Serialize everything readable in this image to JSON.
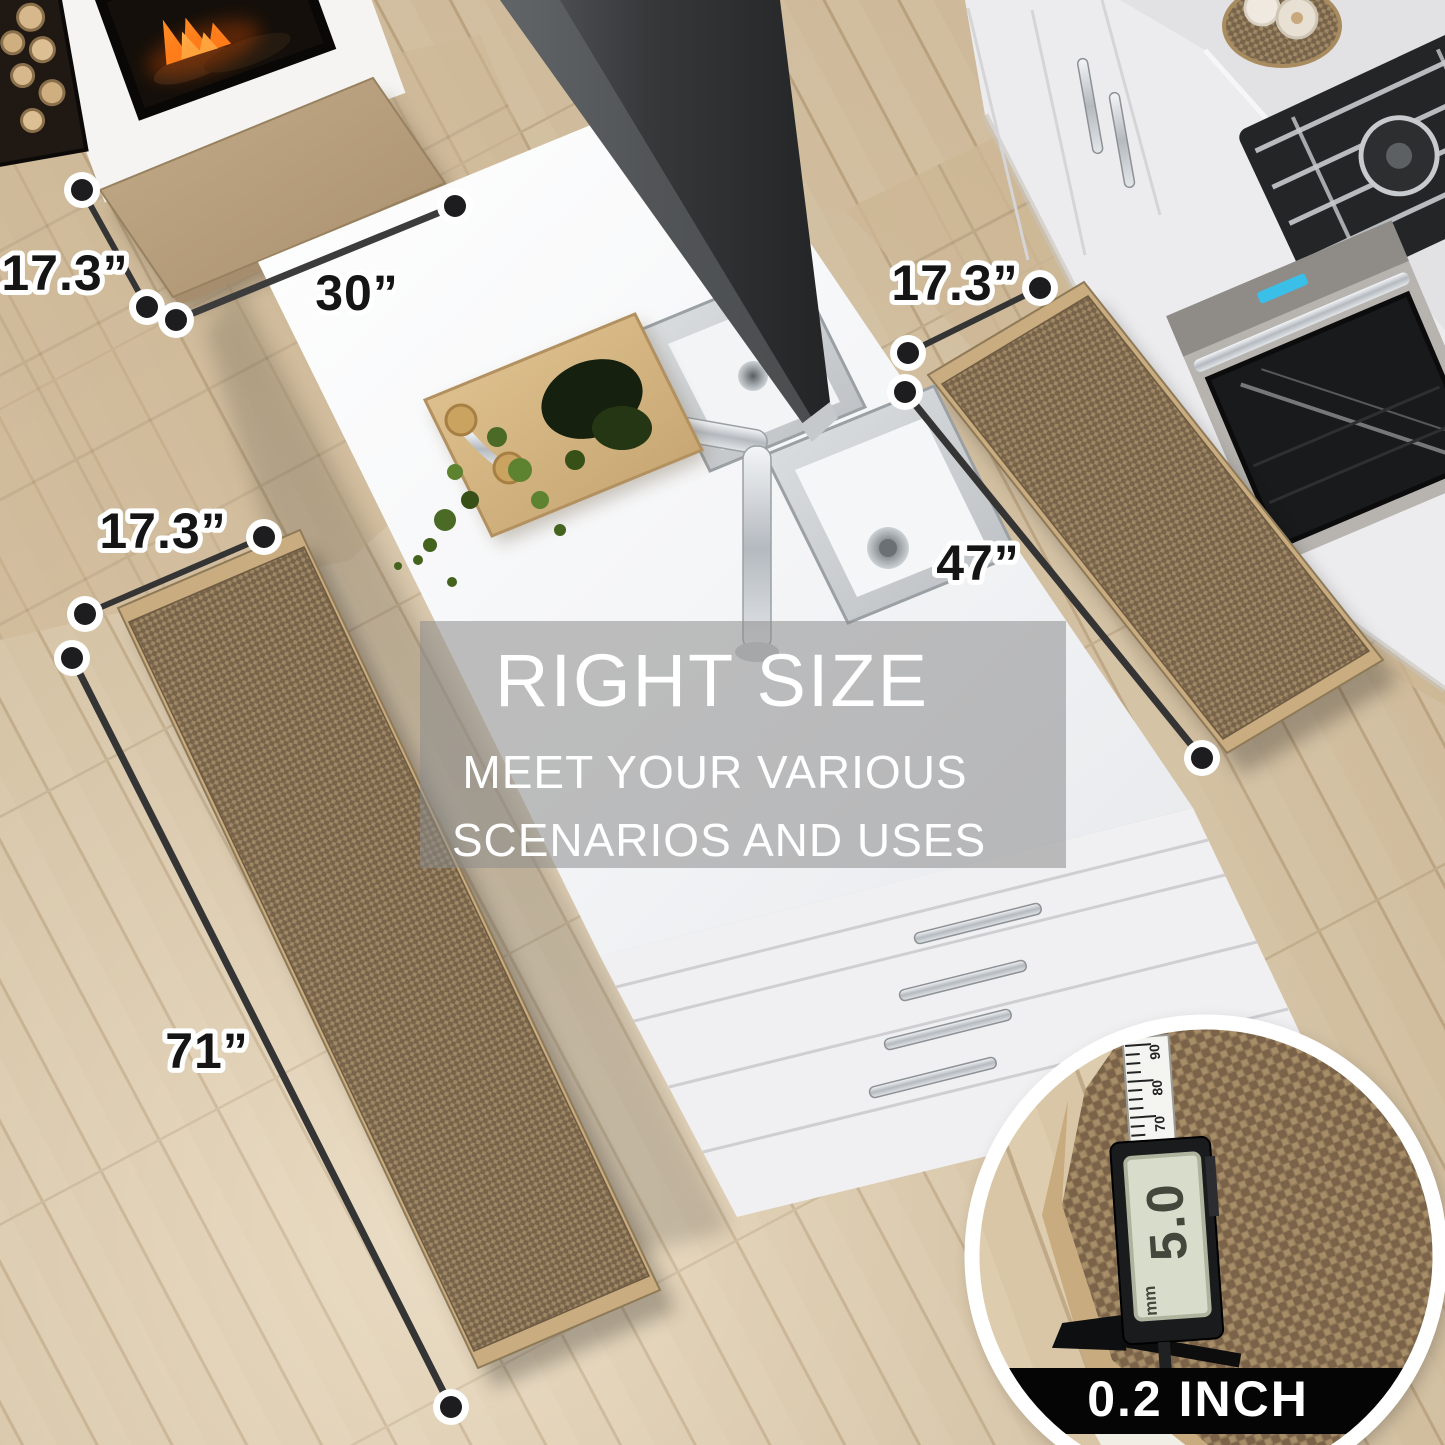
{
  "overlay": {
    "title": "RIGHT SIZE",
    "subtitle_line1": "MEET YOUR VARIOUS",
    "subtitle_line2": "SCENARIOS AND USES"
  },
  "dimensions": {
    "hearth_mat": {
      "depth": "17.3”",
      "width": "30”"
    },
    "sink_mat": {
      "depth": "17.3”",
      "length": "47”"
    },
    "runner_mat": {
      "depth": "17.3”",
      "length": "71”"
    }
  },
  "inset": {
    "thickness": "0.2 INCH",
    "caliper_reading": "5.0",
    "caliper_unit": "mm",
    "ruler_marks": [
      "90",
      "80",
      "70"
    ]
  },
  "colors": {
    "mat_weave": "#8d7758",
    "mat_border": "#c9ad80",
    "overlay_band": "#8c8c8c",
    "annotation_text": "#151515",
    "banner": "#050505",
    "lcd": "#d7dccb"
  }
}
